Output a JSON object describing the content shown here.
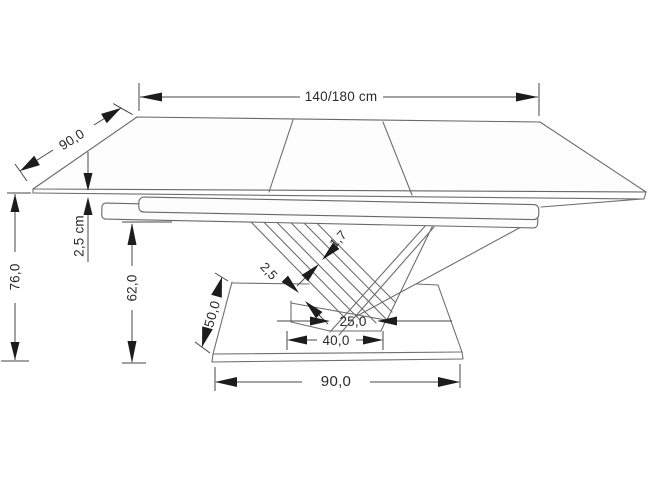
{
  "diagram": {
    "subject": "extendable-dining-table-dimension-drawing",
    "unit": "cm",
    "dims": {
      "top_length": "140/180 cm",
      "top_depth": "90,0",
      "top_thickness": "2,5 cm",
      "total_height": "76,0",
      "understructure_height": "62,0",
      "base_depth": "50,0",
      "panel_thickness": "2,5",
      "strip_thickness": "1,7",
      "foot_length": "25,0",
      "foot_span": "40,0",
      "base_width": "90,0"
    }
  }
}
